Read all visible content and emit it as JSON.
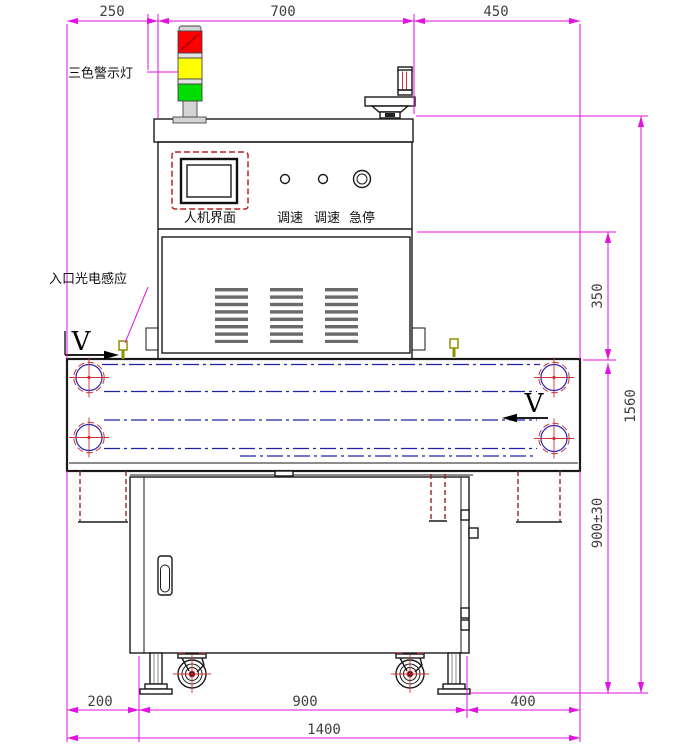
{
  "labels": {
    "warning_light": "三色警示灯",
    "entry_sensor": "入口光电感应",
    "hmi_screen": "人机界面",
    "speed_knob_1": "调速",
    "speed_knob_2": "调速",
    "emergency_stop": "急停",
    "belt_direction_in": "V",
    "belt_direction_out": "V"
  },
  "dimensions": {
    "top_left_offset": "250",
    "top_body_width": "700",
    "top_right_offset": "450",
    "panel_height": "350",
    "total_height": "1560",
    "belt_height": "900±30",
    "bottom_left_offset": "200",
    "cabinet_width": "900",
    "bottom_right_offset": "400",
    "total_width": "1400"
  },
  "colors": {
    "dimension_line": "#e312e3",
    "light_red": "#ff0000",
    "light_yellow": "#ffff00",
    "light_green": "#00dd00",
    "tower_gray": "#d4d4d4",
    "belt_centerline": "#2020a8",
    "roller_red": "#cc3333",
    "hidden_edge_red": "#992222",
    "sensor_olive": "#8f8f00",
    "outline_black": "#1a1a1a",
    "dim_text_gray": "#3f3f3f"
  }
}
